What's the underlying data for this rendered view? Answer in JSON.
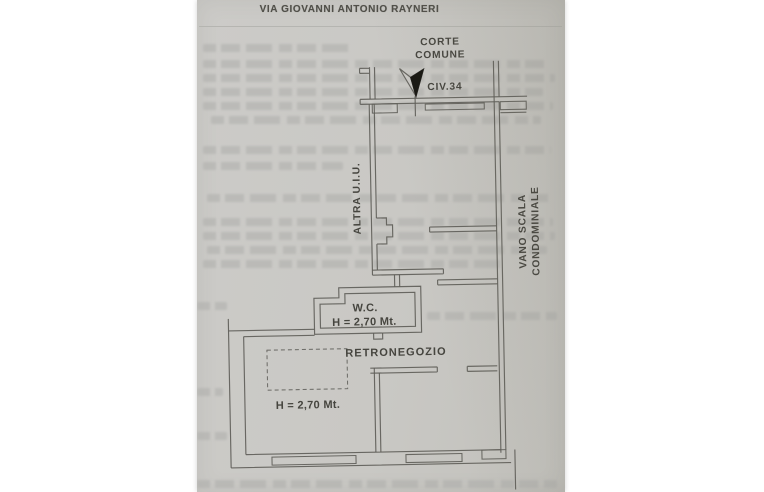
{
  "header": {
    "clipped_line": "DISTACCO VERSO",
    "street_line": "VIA GIOVANNI ANTONIO RAYNERI"
  },
  "plan_labels": {
    "courtyard_line1": "CORTE",
    "courtyard_line2": "COMUNE",
    "civic_number": "CIV.34",
    "adjacent_unit": "ALTRA U.I.U.",
    "stairwell_line1": "VANO SCALA",
    "stairwell_line2": "CONDOMINIALE",
    "wc_name": "W.C.",
    "wc_height": "H = 2,70 Mt.",
    "backroom_name": "RETRONEGOZIO",
    "backroom_height": "H = 2,70 Mt."
  },
  "colors": {
    "paper": "#c9c8c4",
    "paper_edge": "#bdbcb8",
    "line": "#5f5e59",
    "label_text": "#46453f",
    "arrow_fill": "#181712",
    "header_text": "#504f49",
    "bleed_text": "#aeaeab",
    "outside": "#ffffff"
  }
}
